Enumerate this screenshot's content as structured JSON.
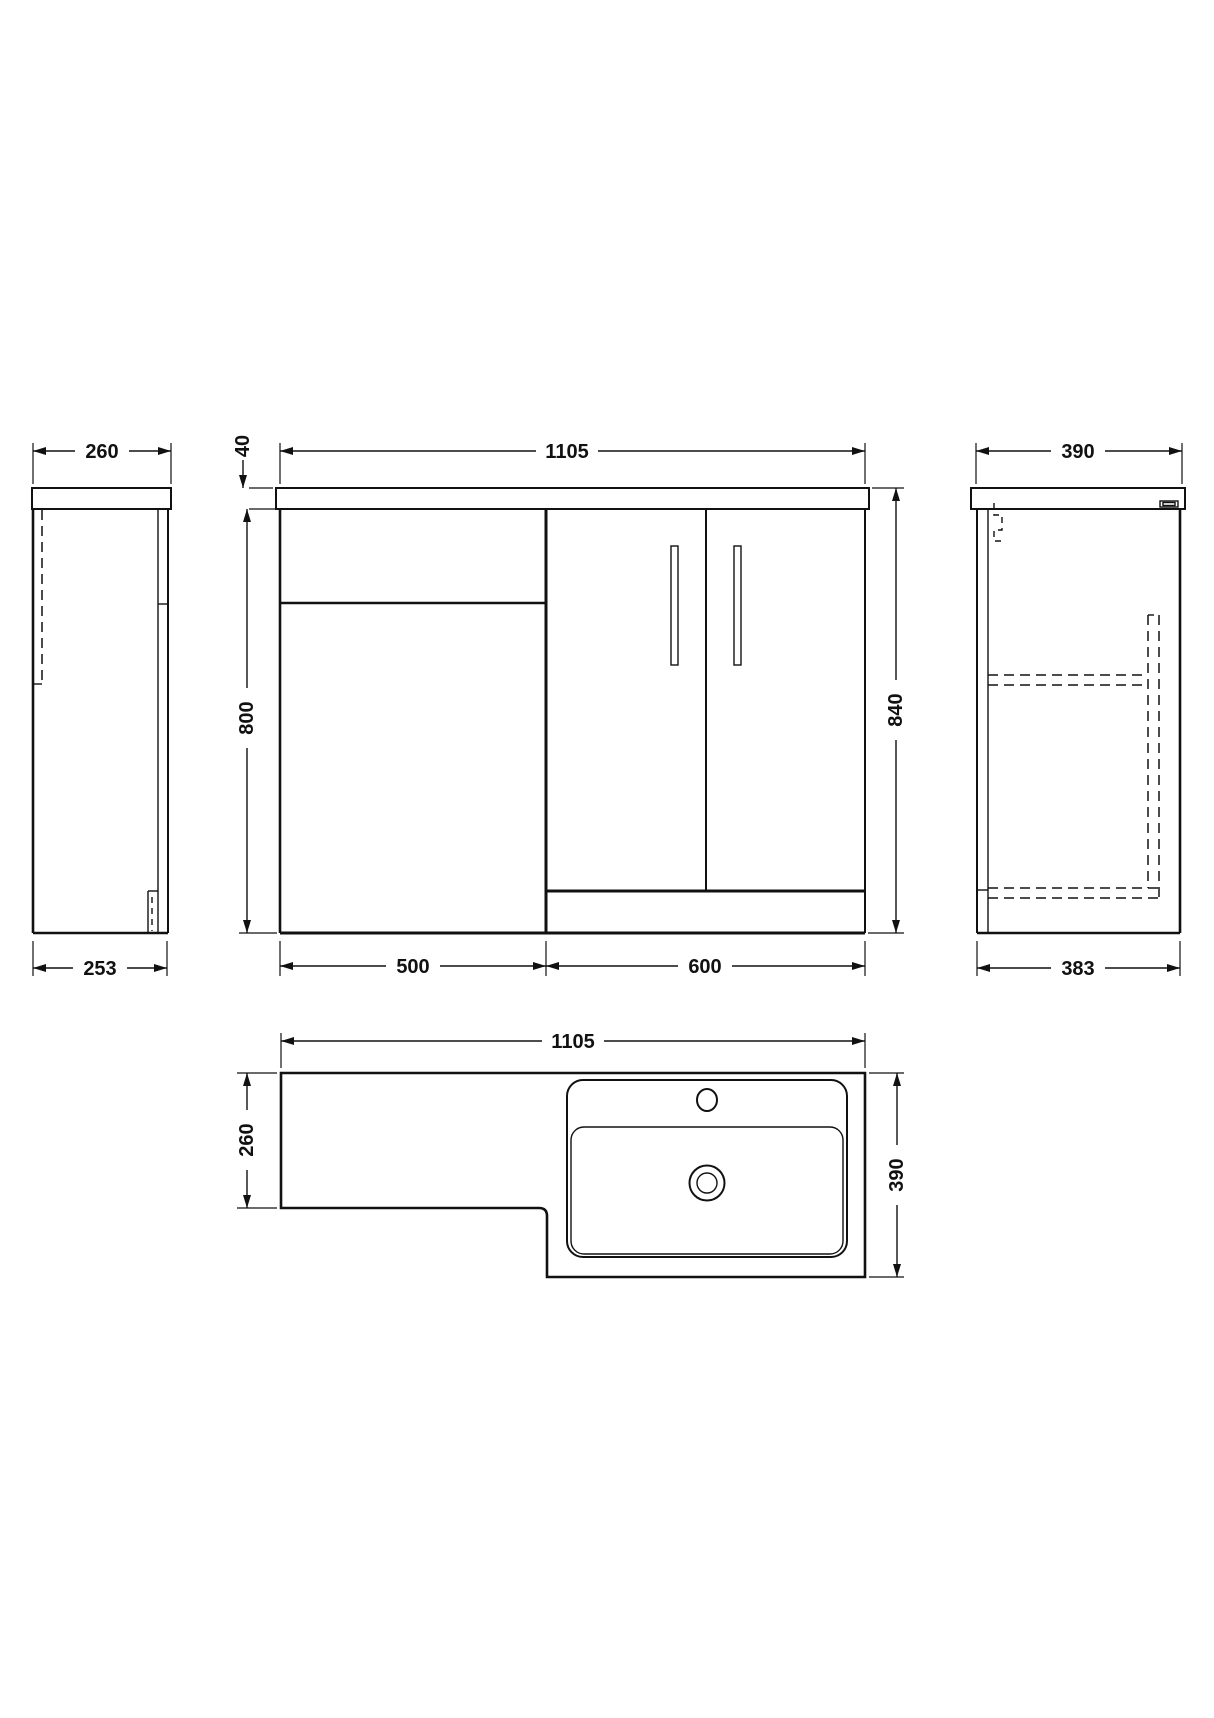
{
  "drawing": {
    "colors": {
      "line": "#111111",
      "background": "#ffffff"
    },
    "views": {
      "side_left": {
        "dims": {
          "top": "260",
          "bottom": "253"
        }
      },
      "front": {
        "dims": {
          "worktop_thickness": "40",
          "overall_width": "1105",
          "carcass_height": "800",
          "overall_height": "840",
          "left_unit_width": "500",
          "right_unit_width": "600"
        }
      },
      "side_right": {
        "dims": {
          "top": "390",
          "bottom": "383"
        }
      },
      "plan": {
        "dims": {
          "overall_width": "1105",
          "left_depth": "260",
          "right_depth": "390"
        }
      }
    }
  }
}
